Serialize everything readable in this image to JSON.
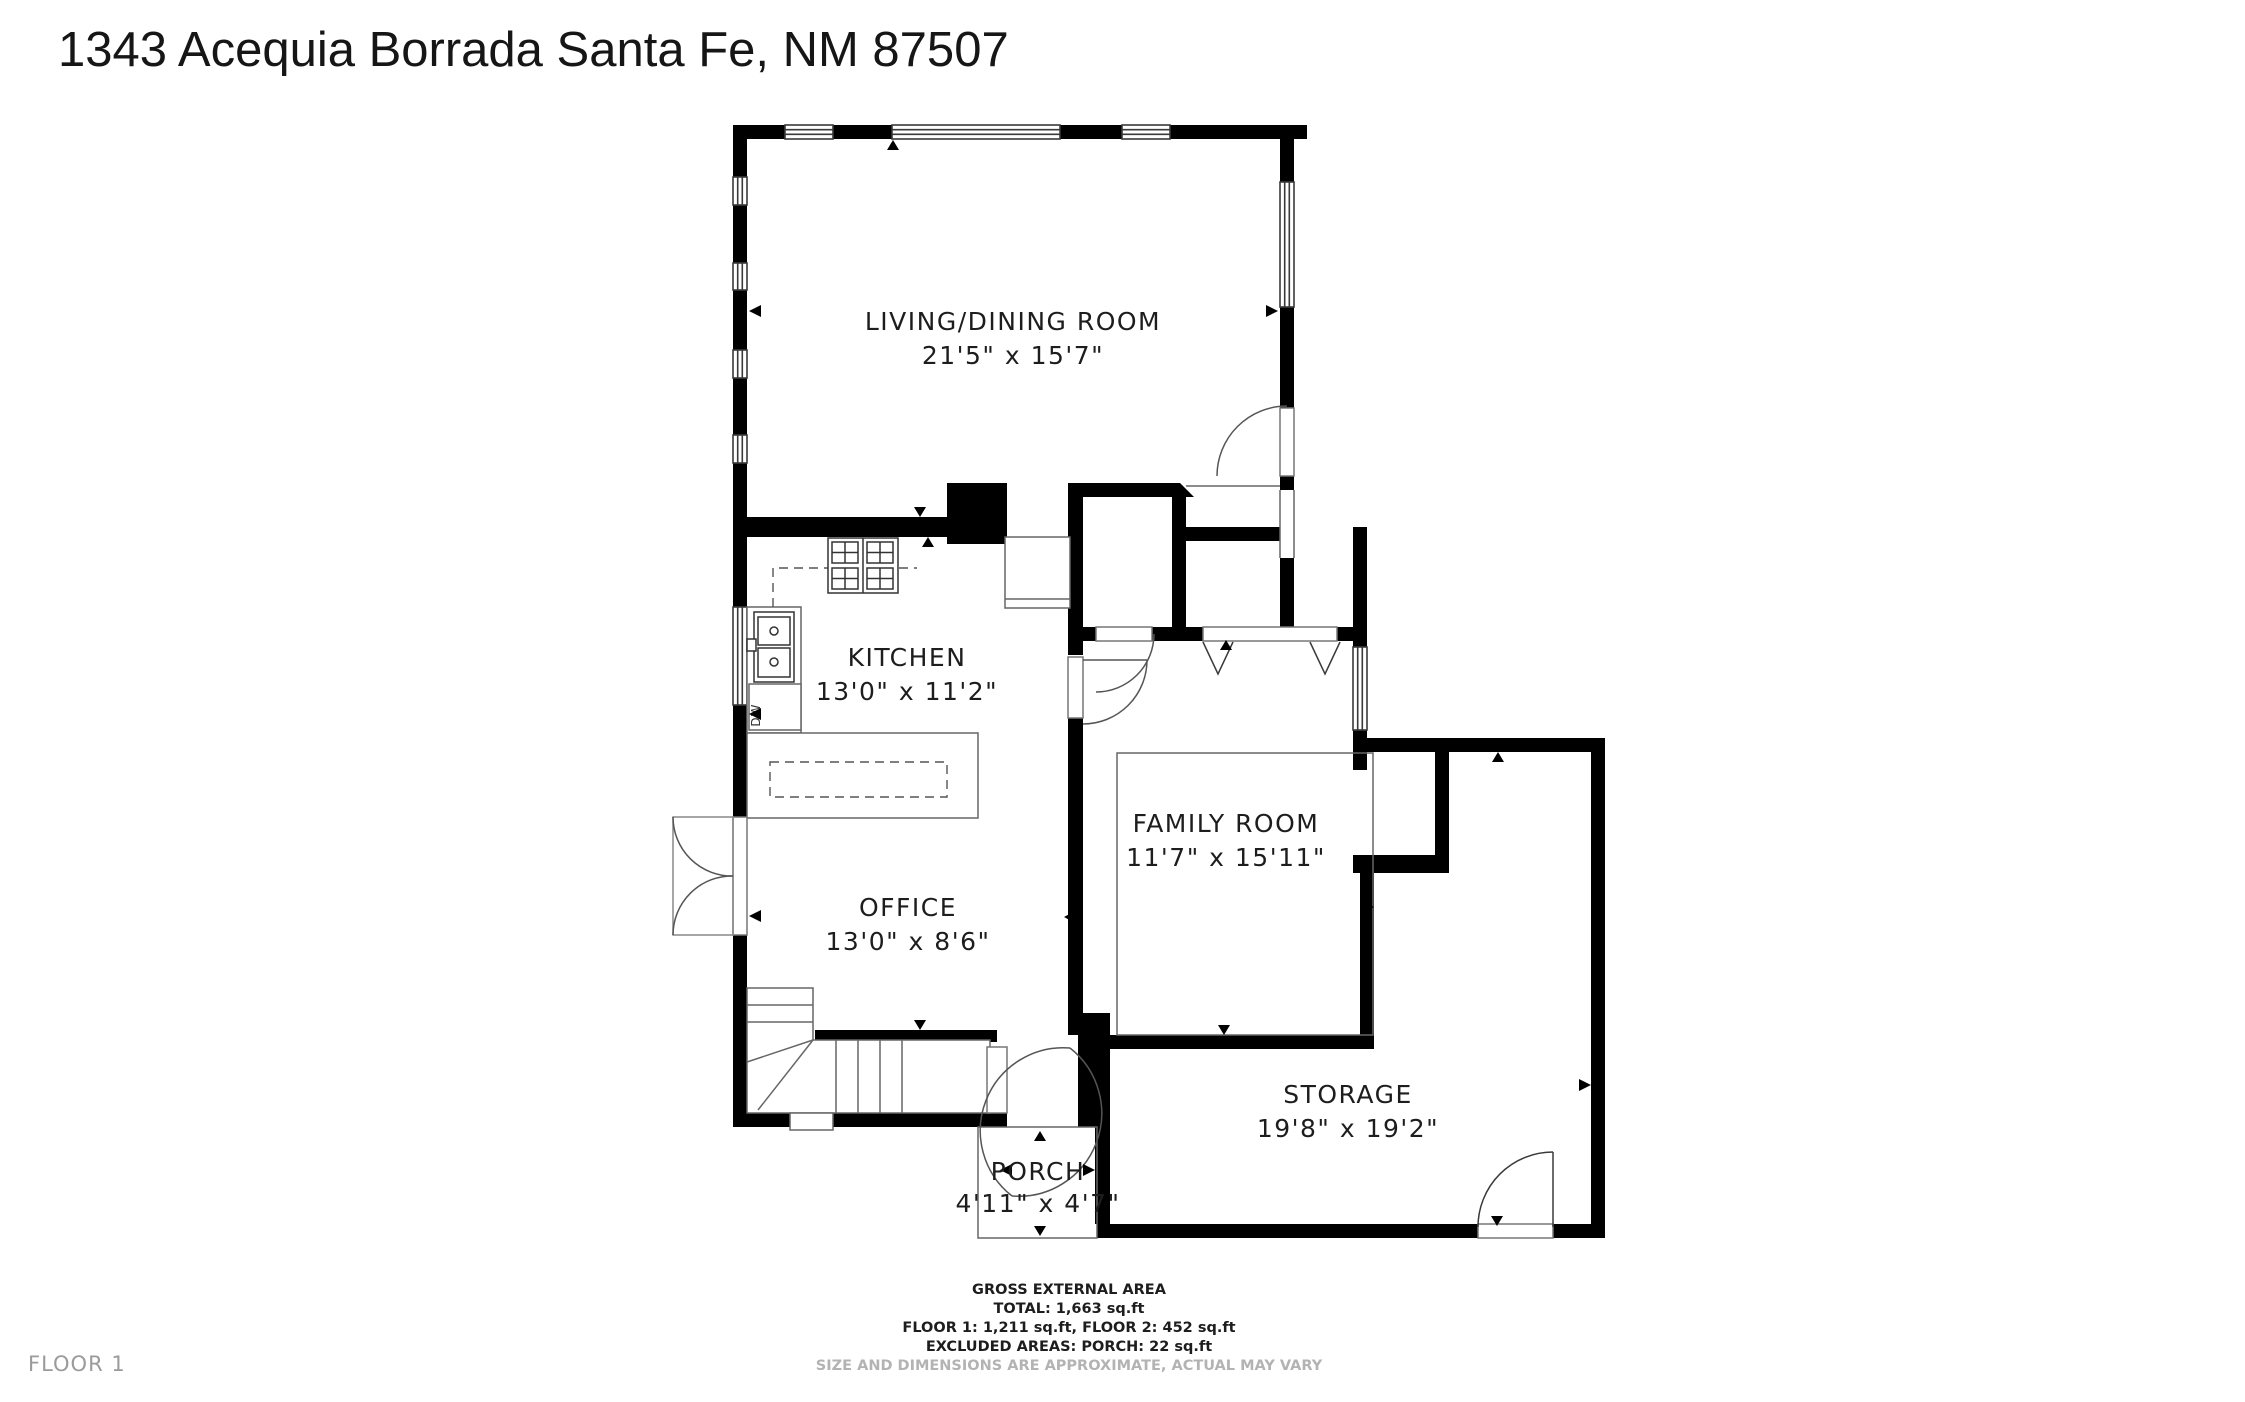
{
  "title": "1343 Acequia Borrada Santa Fe, NM 87507",
  "floor_label": "FLOOR 1",
  "rooms": [
    {
      "name": "LIVING/DINING ROOM",
      "dims": "21'5\" x 15'7\""
    },
    {
      "name": "KITCHEN",
      "dims": "13'0\" x 11'2\""
    },
    {
      "name": "FAMILY ROOM",
      "dims": "11'7\" x 15'11\""
    },
    {
      "name": "OFFICE",
      "dims": "13'0\" x 8'6\""
    },
    {
      "name": "STORAGE",
      "dims": "19'8\" x 19'2\""
    },
    {
      "name": "PORCH",
      "dims": "4'11\" x 4'7\""
    }
  ],
  "appliances": {
    "dw_label": "DW"
  },
  "footer": {
    "line1": "GROSS EXTERNAL AREA",
    "line2": "TOTAL: 1,663 sq.ft",
    "line3": "FLOOR 1: 1,211 sq.ft, FLOOR 2: 452 sq.ft",
    "line4": "EXCLUDED AREAS: PORCH: 22 sq.ft",
    "disclaimer": "SIZE AND DIMENSIONS ARE APPROXIMATE, ACTUAL MAY VARY"
  },
  "colors": {
    "wall": "#000000",
    "thin_line": "#666666",
    "text": "#1d1d1d",
    "muted": "#9b9b9b"
  }
}
